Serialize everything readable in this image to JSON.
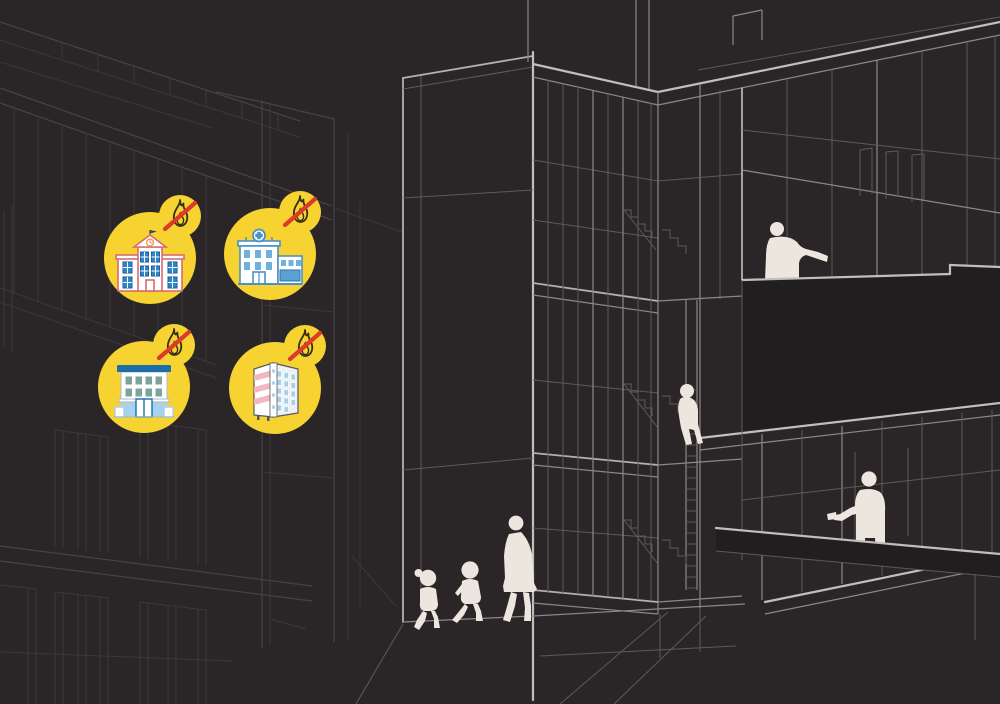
{
  "scene": {
    "label": "fire-safety-building-construction-illustration",
    "elements": "wireframe multi-storey building, background buildings, people silhouettes, four yellow badges with fire-prohibited building icons"
  },
  "colors": {
    "background": "#2a2627",
    "badge_yellow": "#f6d331",
    "prohibition_red": "#dd3b2a",
    "flame_outline": "#352d10",
    "silhouette": "#ece6de",
    "line_bright": "#b2b0b0",
    "line_mid": "#8b8889",
    "line_faint": "#5d5a5b",
    "line_background_building": "#474344"
  },
  "badges": [
    {
      "id": "school",
      "icon": "school-building-icon",
      "overlay": "no-fire-icon"
    },
    {
      "id": "hospital",
      "icon": "hospital-building-icon",
      "overlay": "no-fire-icon"
    },
    {
      "id": "house",
      "icon": "residential-house-icon",
      "overlay": "no-fire-icon"
    },
    {
      "id": "apartment",
      "icon": "apartment-building-icon",
      "overlay": "no-fire-icon"
    }
  ],
  "figures": [
    {
      "id": "woman-walking"
    },
    {
      "id": "child-walking"
    },
    {
      "id": "child-with-ponytail-walking"
    },
    {
      "id": "person-on-balcony"
    },
    {
      "id": "child-on-stairs"
    },
    {
      "id": "person-in-corridor"
    }
  ]
}
